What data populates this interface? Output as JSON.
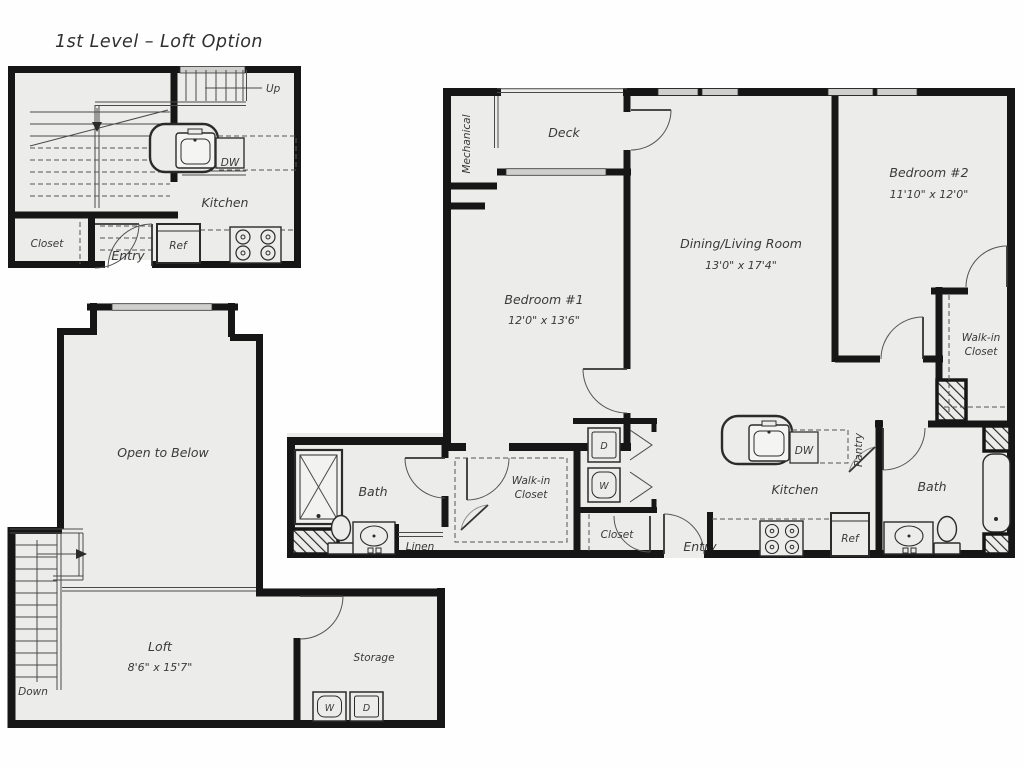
{
  "title": "1st Level – Loft Option",
  "colors": {
    "floor": "#ECECEA",
    "wall": "#161616",
    "window": "#CFCFCD",
    "text": "#3A3A3A"
  },
  "first_level": {
    "kitchen": {
      "label": "Kitchen",
      "dw": "DW",
      "ref": "Ref"
    },
    "closet": "Closet",
    "entry": "Entry",
    "up": "Up"
  },
  "loft_level": {
    "open_to_below": "Open to Below",
    "loft": {
      "label": "Loft",
      "dims": "8'6\" x 15'7\""
    },
    "storage": {
      "label": "Storage",
      "washer": "W",
      "dryer": "D"
    },
    "down": "Down"
  },
  "main_unit": {
    "mechanical": "Mechanical",
    "deck": "Deck",
    "bedroom1": {
      "label": "Bedroom #1",
      "dims": "12'0\" x 13'6\""
    },
    "living": {
      "label": "Dining/Living Room",
      "dims": "13'0\" x 17'4\""
    },
    "bedroom2": {
      "label": "Bedroom #2",
      "dims": "11'10\" x 12'0\""
    },
    "walkin1": {
      "line1": "Walk-in",
      "line2": "Closet"
    },
    "walkin2": {
      "line1": "Walk-in",
      "line2": "Closet"
    },
    "bath1": "Bath",
    "bath2": "Bath",
    "linen": "Linen",
    "closet": "Closet",
    "entry": "Entry",
    "kitchen": {
      "label": "Kitchen",
      "dw": "DW",
      "ref": "Ref",
      "pantry": "Pantry"
    },
    "laundry": {
      "washer": "W",
      "dryer": "D"
    }
  }
}
